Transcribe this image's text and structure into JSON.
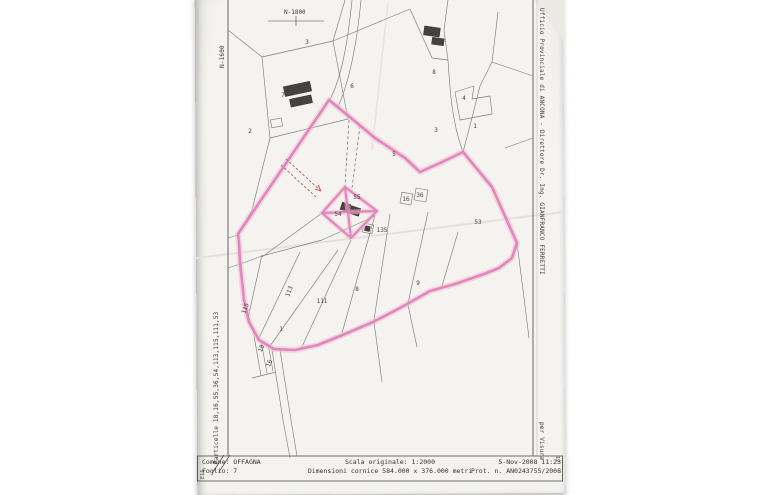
{
  "margins": {
    "right_stamp": "Ufficio Provinciale di ANCONA - Direttore  Dr. Ing. GIANFRANCO FERRETTI",
    "per_visura": "per Visura",
    "particelle": "Particelle 18,16,55,36,54,113,115,111,53",
    "grid_top": "N-1800",
    "grid_left": "N-1600",
    "corner_left": "E11",
    "corner_right": "12"
  },
  "title_block": {
    "comune": "Comune: OFFAGNA",
    "foglio": "Foglio: 7",
    "scala": "Scala originale: 1:2000",
    "dimensioni": "Dimensioni cornice  584.000 x 376.000 metri",
    "datetime": "5-Nov-2008 11:23",
    "protocollo": "Prot. n. AN0243755/2008"
  },
  "map": {
    "highlight_color": "#dd7fb4",
    "annotation_color": "#c4605e",
    "labels": [
      {
        "text": "3",
        "x": 307,
        "y": 44
      },
      {
        "text": "7",
        "x": 283,
        "y": 97
      },
      {
        "text": "2",
        "x": 250,
        "y": 133
      },
      {
        "text": "6",
        "x": 352,
        "y": 88
      },
      {
        "text": "8",
        "x": 434,
        "y": 74
      },
      {
        "text": "4",
        "x": 464,
        "y": 100
      },
      {
        "text": "3",
        "x": 436,
        "y": 132
      },
      {
        "text": "1",
        "x": 475,
        "y": 128
      },
      {
        "text": "5",
        "x": 394,
        "y": 156
      },
      {
        "text": "16",
        "x": 406,
        "y": 201
      },
      {
        "text": "36",
        "x": 420,
        "y": 197
      },
      {
        "text": "54",
        "x": 338,
        "y": 216
      },
      {
        "text": "55",
        "x": 357,
        "y": 199
      },
      {
        "text": "135",
        "x": 382,
        "y": 232
      },
      {
        "text": "53",
        "x": 478,
        "y": 224
      },
      {
        "text": "9",
        "x": 418,
        "y": 285
      },
      {
        "text": "8",
        "x": 357,
        "y": 291
      },
      {
        "text": "113",
        "x": 291,
        "y": 292,
        "rot": -70
      },
      {
        "text": "111",
        "x": 322,
        "y": 303
      },
      {
        "text": "115",
        "x": 247,
        "y": 309,
        "rot": -70
      },
      {
        "text": "1",
        "x": 281,
        "y": 331
      },
      {
        "text": "18",
        "x": 263,
        "y": 349,
        "rot": -70
      },
      {
        "text": "16",
        "x": 271,
        "y": 364,
        "rot": -70
      }
    ]
  }
}
